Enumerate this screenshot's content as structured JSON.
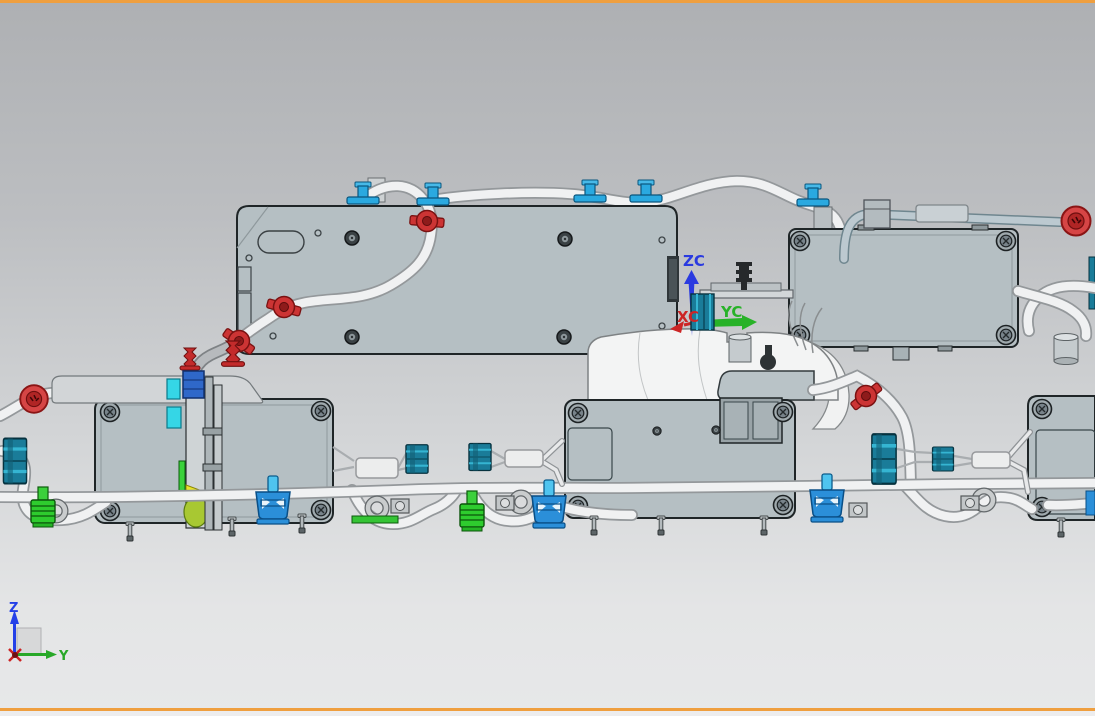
{
  "viewport": {
    "border_color": "#ef9f3f",
    "bg_top": "#aeb0b3",
    "bg_bottom": "#e7e8e9"
  },
  "wcs_triad": {
    "z_label": "ZC",
    "x_label": "XC",
    "y_label": "YC",
    "z_color": "#2a3ae0",
    "x_color": "#cc2525",
    "y_color": "#28b228"
  },
  "view_triad": {
    "z_label": "Z",
    "y_label": "Y",
    "z_color": "#2440e8",
    "y_color": "#28a828",
    "x_color": "#cc2222"
  },
  "palette": {
    "module_fill": "#b5bfc3",
    "module_edge": "#1f2527",
    "tube_light": "#f0f1f2",
    "tube_shade": "#94989b",
    "steel_tube": "#bcc9d0",
    "clip_blue": "#2aa9e0",
    "clamp_blue": "#2b8fd9",
    "connector_teal": "#1a7c99",
    "connector_green": "#2ecc2e",
    "accent_red": "#cc3434",
    "highlight_cyan": "#35d6e6",
    "highlight_yellow": "#e9e428"
  }
}
